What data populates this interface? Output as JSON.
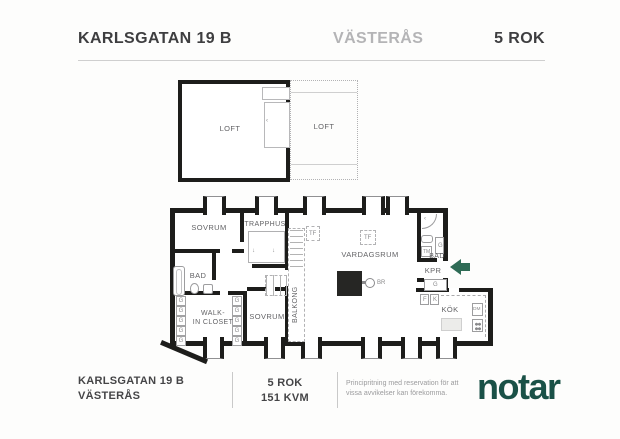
{
  "header": {
    "address": "KARLSGATAN 19 B",
    "city": "VÄSTERÅS",
    "rooms": "5 ROK"
  },
  "loft": {
    "left_label": "LOFT",
    "right_label": "LOFT"
  },
  "plan": {
    "sovrum_top": "SOVRUM",
    "trapphus": "TRAPPHUS",
    "bad_left": "BAD",
    "walkin": "WALK-\nIN CLOSET",
    "sovrum_bottom": "SOVRUM",
    "balkong": "BALKONG",
    "vardagsrum": "VARDAGSRUM",
    "bad_right": "BAD",
    "kpr": "KPR",
    "kok": "KÖK",
    "tf": "TF",
    "br": "BR",
    "g": "G",
    "tm": "TM",
    "f": "F",
    "k": "K",
    "dm": "DM"
  },
  "footer": {
    "address_line1": "KARLSGATAN 19 B",
    "address_line2": "VÄSTERÅS",
    "rooms": "5 ROK",
    "area": "151 KVM",
    "disclaimer": "Principritning med reservation för att vissa avvikelser kan förekomma.",
    "brand": "notar"
  },
  "colors": {
    "wall": "#1d1d1b",
    "notar_green": "#1a5147",
    "arrow_green": "#2e6b55"
  }
}
